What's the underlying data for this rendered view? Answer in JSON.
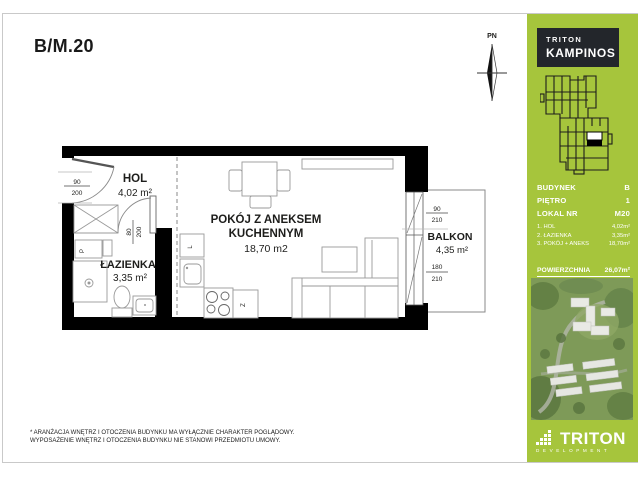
{
  "title": "B/M.20",
  "north_label": "PN",
  "colors": {
    "sidebar_green": "#a6c53c",
    "badge_dark": "#23262b",
    "wall_black": "#000000"
  },
  "plan": {
    "hol": {
      "name": "HOL",
      "area": "4,02 m²"
    },
    "lazienka": {
      "name": "ŁAZIENKA",
      "area": "3,35 m²"
    },
    "pokoj": {
      "name_line1": "POKÓJ Z ANEKSEM",
      "name_line2": "KUCHENNYM",
      "area": "18,70 m2"
    },
    "balkon": {
      "name": "BALKON",
      "area": "4,35 m²"
    },
    "dims": {
      "entrance_w": "90",
      "entrance_h": "200",
      "bath_door_w": "80",
      "bath_door_h": "200",
      "balcony_door_w": "90",
      "balcony_door_h": "210",
      "balcony_win_w": "180",
      "balcony_win_h": "210"
    },
    "fixtures": {
      "washer": "P",
      "fridge": "L",
      "dishwasher": "Z"
    }
  },
  "sidebar": {
    "brand_top": "TRITON",
    "brand_bottom": "KAMPINOS",
    "info": [
      {
        "label": "BUDYNEK",
        "value": "B"
      },
      {
        "label": "PIĘTRO",
        "value": "1"
      },
      {
        "label": "LOKAL NR",
        "value": "M20"
      }
    ],
    "rooms": [
      {
        "name": "1. HOL",
        "value": "4,02m²"
      },
      {
        "name": "2. ŁAZIENKA",
        "value": "3,35m²"
      },
      {
        "name": "3. POKÓJ + ANEKS",
        "value": "18,70m²"
      }
    ],
    "area_label": "POWIERZCHNIA",
    "area_value": "26,07m²",
    "balcony_label": "+ BALKON",
    "balcony_value": "4,35m²",
    "logo_name": "TRITON",
    "logo_sub": "DEVELOPMENT"
  },
  "disclaimer": {
    "line1": "* ARANŻACJA WNĘTRZ I OTOCZENIA BUDYNKU MA WYŁĄCZNIE CHARAKTER POGLĄDOWY.",
    "line2": "WYPOSAŻENIE WNĘTRZ I OTOCZENIA BUDYNKU NIE STANOWI PRZEDMIOTU UMOWY."
  }
}
